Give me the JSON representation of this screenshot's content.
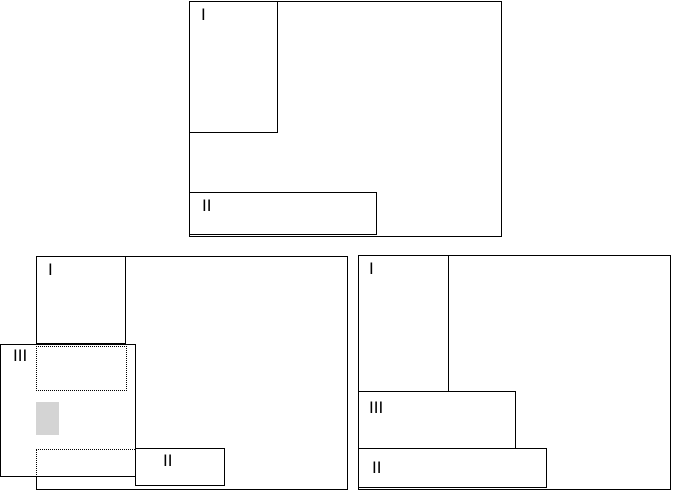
{
  "colors": {
    "line": "#000000",
    "background": "#ffffff",
    "ghost_fill": "#d4d4d4"
  },
  "panels": {
    "top": {
      "window_i": "I",
      "window_ii": "II"
    },
    "bottom_left": {
      "window_i": "I",
      "window_ii": "II",
      "window_iii": "III"
    },
    "bottom_right": {
      "window_i": "I",
      "window_ii": "II",
      "window_iii": "III"
    }
  }
}
